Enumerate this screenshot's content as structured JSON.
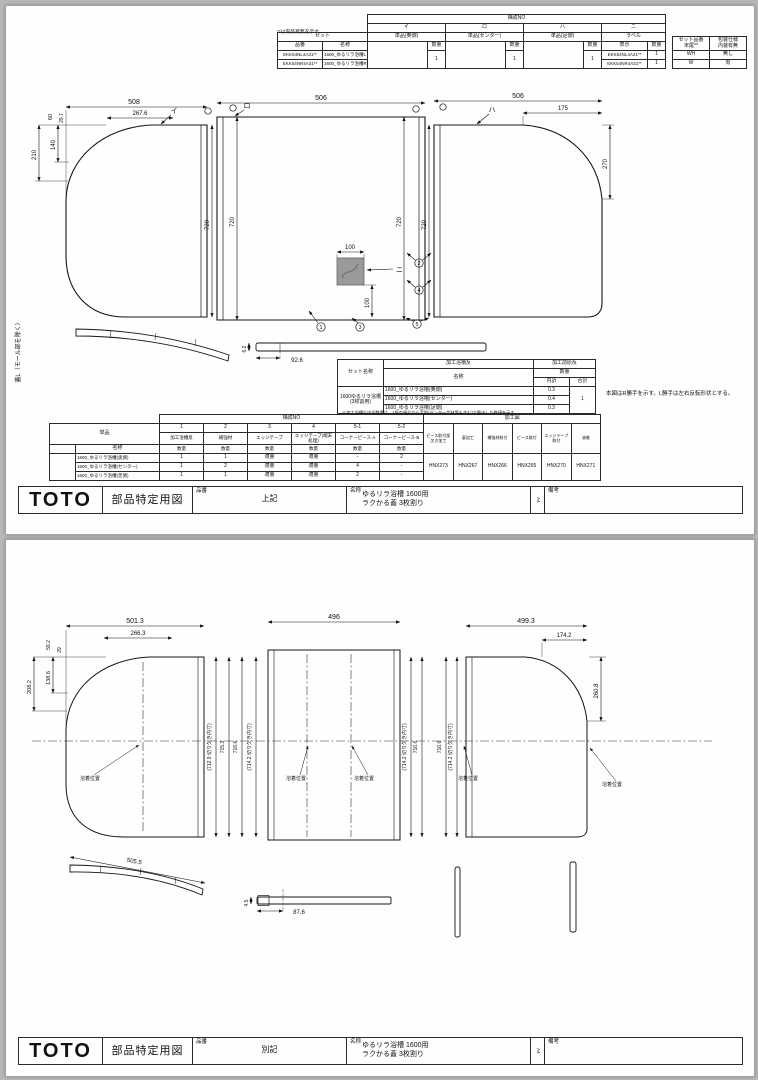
{
  "page1": {
    "top_table": {
      "note": "**は内装有無を示す。",
      "set": "セット",
      "hinban": "品番",
      "meisho": "名称",
      "kosei_no": "構成NO",
      "qty": "数量",
      "disp": "表示",
      "col_i": "イ",
      "col_ro": "ロ",
      "col_ha": "ハ",
      "col_ni": "ニ",
      "name_i": "単品(奥側)",
      "name_ro": "単品(センター)",
      "name_ha": "単品(足側)",
      "name_ni": "ラベル",
      "qty_i": "1",
      "qty_ro": "1",
      "qty_ha": "1",
      "rows": [
        {
          "hinban": "EKK54NL4A31**",
          "meisho": "1600_ゆるリラ浴槽L",
          "label": "EKK54NL4A21**",
          "label_qty": "1",
          "tail": "WH",
          "naiso": "無し"
        },
        {
          "hinban": "EKK54NR4A31**",
          "meisho": "1600_ゆるリラ浴槽R",
          "label": "EKK54NR4A21**",
          "label_qty": "1",
          "tail": "W",
          "naiso": "有"
        }
      ],
      "tail_h1a": "セット品番",
      "tail_h1b": "末尾**",
      "tail_h2a": "包装仕様",
      "tail_h2b": "内装有無"
    },
    "drawing": {
      "labels": {
        "i": "イ",
        "ro": "ロ",
        "ha": "ハ",
        "ni": "ニ"
      },
      "callouts": {
        "c1": "1",
        "c2": "2",
        "c3": "3",
        "c4": "4",
        "c5": "5"
      },
      "dims": {
        "d508": "508",
        "d2676": "267.6",
        "d60": "60",
        "d297": "29.7",
        "d140": "140",
        "d210": "210",
        "d720": "720",
        "d506": "506",
        "d175": "175",
        "d270": "270",
        "d100": "100",
        "d926": "92.6",
        "d62": "6.2"
      }
    },
    "side_note": "蓋L（モール部を除く）",
    "mirror_note": "本図はR勝手を示す。L勝手は左右反転形状とする。",
    "mid_table": {
      "set_name_label": "セット名称",
      "set_name1": "1600ゆるリラ浴槽",
      "set_name2": "(3枚割用)",
      "kako_yokuso": "加工浴槽反",
      "kako_mae": "加工前原反",
      "meisho": "名称",
      "qty": "数量",
      "uchiwake": "内訳",
      "gokei": "合計",
      "rows": [
        {
          "name": "1600_ゆるリラ浴槽(奥側)",
          "v": "0.3"
        },
        {
          "name": "1600_ゆるリラ浴槽(センター)",
          "v": "0.4"
        },
        {
          "name": "1600_ゆるリラ浴槽(足側)",
          "v": "0.3"
        }
      ],
      "total": "1",
      "note": "※加工浴槽反内訳数量は、1枚の原反から実取(センター芯材等も含む)で算出した数値を示す。"
    },
    "bottom_table": {
      "kosei_no": "構成NO",
      "kako_zu": "加工図",
      "tanpin": "単品",
      "meisho": "名称",
      "qty": "数量",
      "comp_nos": [
        "1",
        "2",
        "3",
        "4",
        "5-1",
        "5-2"
      ],
      "comp_names": [
        "加工浴槽反",
        "補強材",
        "エッジテープ",
        "エッジテープ(端末処理)",
        "コーナーピース-A",
        "コーナーピース-B"
      ],
      "proc_names": [
        "ピース取付部欠き加工",
        "裏加工",
        "補強材取付",
        "ピース取付",
        "エッジテープ取付",
        "溶着"
      ],
      "proc_codes": [
        "HNX273",
        "HNX267",
        "HNX266",
        "HNX265",
        "HNX270",
        "HNX271"
      ],
      "rows": [
        {
          "name": "1600_ゆるリラ浴槽(奥側)",
          "v": [
            "1",
            "1",
            "適量",
            "適量",
            "-",
            "2"
          ]
        },
        {
          "name": "1600_ゆるリラ浴槽(センター)",
          "v": [
            "1",
            "2",
            "適量",
            "適量",
            "4",
            "-"
          ]
        },
        {
          "name": "1600_ゆるリラ浴槽(足側)",
          "v": [
            "1",
            "1",
            "適量",
            "適量",
            "2",
            "-"
          ]
        }
      ]
    },
    "title_block": {
      "logo": "TOTO",
      "doc_type": "部品特定用図",
      "hinban_label": "品番",
      "hinban_value": "上記",
      "meisho_label": "名称",
      "meisho_value1": "ゆるリラ浴槽 1600用",
      "meisho_value2": "ラクかる蓋 3枚割り",
      "scale_note": "A4",
      "biko_label": "備考"
    }
  },
  "page2": {
    "drawing": {
      "dims": {
        "d5013": "501.3",
        "d2663": "266.3",
        "d592": "59.2",
        "d29": "29",
        "d1386": "138.6",
        "d2082": "208.2",
        "d496": "496",
        "d4993": "499.3",
        "d1742": "174.2",
        "d2608": "260.8",
        "cut_7129": "(712.9 切り欠き内寸)",
        "v7153": "715.3",
        "v7166": "716.6",
        "cut_7142": "(714.2 切り欠き内寸)",
        "d5055": "505.5",
        "d876": "87.6",
        "d45": "4.5"
      },
      "weld_label": "溶着位置"
    },
    "title_block": {
      "logo": "TOTO",
      "doc_type": "部品特定用図",
      "hinban_label": "品番",
      "hinban_value": "別記",
      "meisho_label": "名称",
      "meisho_value1": "ゆるリラ浴槽 1600用",
      "meisho_value2": "ラクかる蓋 3枚割り",
      "scale_note": "A4",
      "biko_label": "備考"
    }
  }
}
